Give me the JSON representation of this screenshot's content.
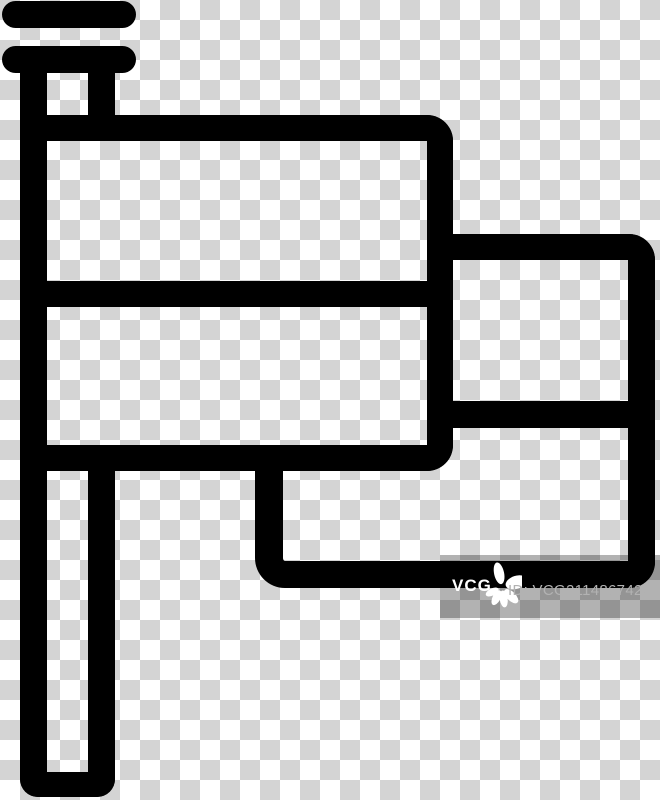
{
  "icon": {
    "name": "flag-icon",
    "style": "outline"
  },
  "colors": {
    "icon_ink": "#000000",
    "checker_light": "#ffffff",
    "checker_dark": "#d4d4d4",
    "watermark_overlay": "rgba(0,0,0,0.30)",
    "watermark_brand": "#ffffff",
    "watermark_id": "#b2b2b2"
  },
  "watermark": {
    "brand": "VCG",
    "id_text": "ID: VCG211486742211"
  }
}
